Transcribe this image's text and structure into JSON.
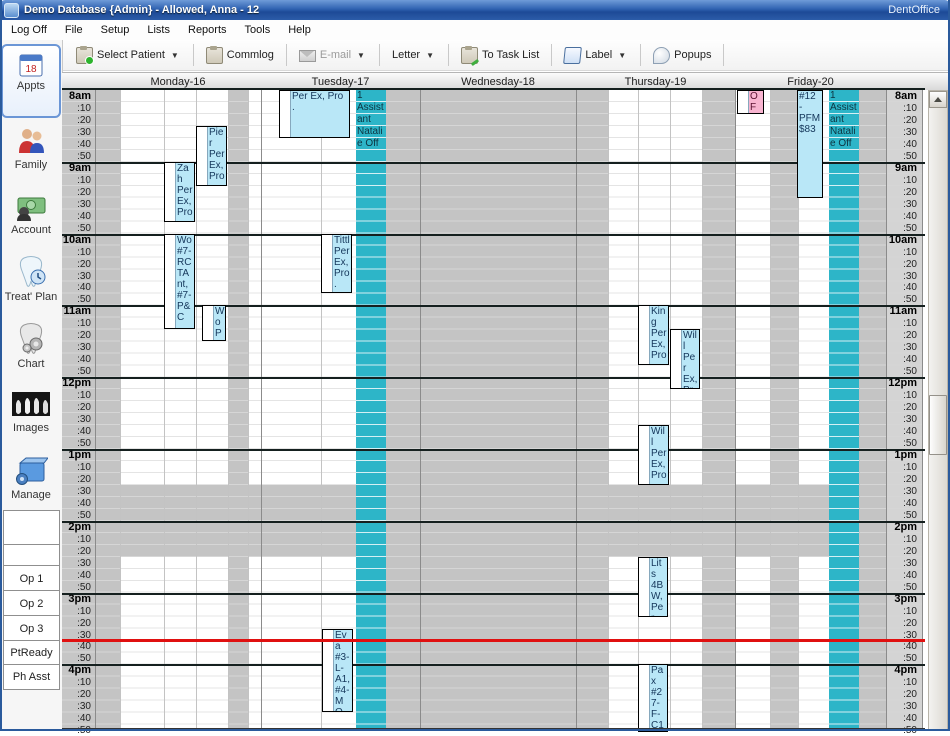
{
  "window": {
    "title": "Demo Database {Admin} - Allowed, Anna - 12",
    "brand": "DentOffice"
  },
  "menu": {
    "items": [
      "Log Off",
      "File",
      "Setup",
      "Lists",
      "Reports",
      "Tools",
      "Help"
    ]
  },
  "toolbar": {
    "select_patient": "Select Patient",
    "commlog": "Commlog",
    "email": "E-mail",
    "letter": "Letter",
    "to_task_list": "To Task List",
    "label": "Label",
    "popups": "Popups"
  },
  "sidebar": {
    "modules": [
      {
        "label": "Appts",
        "selected": true
      },
      {
        "label": "Family"
      },
      {
        "label": "Account"
      },
      {
        "label": "Treat' Plan"
      },
      {
        "label": "Chart"
      },
      {
        "label": "Images"
      },
      {
        "label": "Manage"
      }
    ],
    "op_buttons": [
      "",
      "",
      "Op 1",
      "Op 2",
      "Op 3",
      "PtReady",
      "Ph Asst"
    ]
  },
  "schedule": {
    "days": [
      "Monday-16",
      "Tuesday-17",
      "Wednesday-18",
      "Thursday-19",
      "Friday-20"
    ],
    "hours": [
      "8am",
      "9am",
      "10am",
      "11am",
      "12pm",
      "1pm",
      "2pm",
      "3pm",
      "4pm"
    ],
    "minutes": [
      ":10",
      ":20",
      ":30",
      ":40",
      ":50"
    ],
    "lunch_closed_band": {
      "start": "13:30",
      "end": "14:30"
    },
    "current_time": "15:40",
    "appointments": [
      {
        "id": "mon_pier",
        "day": 0,
        "start": "8:30",
        "end": "9:20",
        "text": "Pier Per Ex, Pro .",
        "kind": "appt"
      },
      {
        "id": "mon_zah",
        "day": 0,
        "start": "9:00",
        "end": "9:50",
        "text": "Zah Per Ex, Pro .",
        "kind": "appt"
      },
      {
        "id": "mon_wo1",
        "day": 0,
        "start": "10:00",
        "end": "11:20",
        "text": "Wo #7-RCTAnt, #7-P&C",
        "kind": "appt"
      },
      {
        "id": "mon_wo2",
        "day": 0,
        "start": "11:00",
        "end": "11:30",
        "text": "Wo Pro Chi",
        "kind": "appt"
      },
      {
        "id": "tue_per",
        "day": 1,
        "start": "8:00",
        "end": "8:40",
        "text": "Per Ex, Pro .",
        "kind": "appt"
      },
      {
        "id": "tue_tittl",
        "day": 1,
        "start": "10:00",
        "end": "10:50",
        "text": "Tittl Per Ex, Pro .",
        "kind": "appt"
      },
      {
        "id": "tue_eva",
        "day": 1,
        "start": "15:30",
        "end": "16:40",
        "text": "Eva #3-L-A1, #4-MO -",
        "kind": "appt"
      },
      {
        "id": "thu_king",
        "day": 3,
        "start": "11:00",
        "end": "11:50",
        "text": "King Per Ex, Pro .",
        "kind": "appt"
      },
      {
        "id": "thu_will1",
        "day": 3,
        "start": "11:20",
        "end": "12:10",
        "text": "Will Per Ex, Pro .",
        "kind": "appt"
      },
      {
        "id": "thu_will2",
        "day": 3,
        "start": "12:40",
        "end": "13:30",
        "text": "Will Per Ex, Pro .",
        "kind": "appt"
      },
      {
        "id": "thu_lits",
        "day": 3,
        "start": "14:30",
        "end": "15:20",
        "text": "Lits 4BW, Per Ex,",
        "kind": "appt"
      },
      {
        "id": "thu_pax",
        "day": 3,
        "start": "16:00",
        "end": "17:00",
        "text": "Pax #27-F-C1, #28",
        "kind": "appt"
      },
      {
        "id": "fri_off",
        "day": 4,
        "start": "8:00",
        "end": "8:20",
        "text": "OFF",
        "kind": "off"
      },
      {
        "id": "fri_12",
        "day": 4,
        "start": "8:00",
        "end": "9:30",
        "text": "#12 - PFM $83",
        "kind": "appt_nostrip"
      }
    ],
    "blockouts": [
      {
        "id": "bo_tue",
        "day": 1,
        "start": "8:00",
        "end": "8:50",
        "text": "1 Assistant Natalie Off"
      },
      {
        "id": "bo_fri",
        "day": 4,
        "start": "8:00",
        "end": "8:50",
        "text": "1 Assistant Natalie Off"
      }
    ],
    "colors": {
      "appointment_blue": "#b9e7f7",
      "blockout_teal": "#2db5c8",
      "off_pink": "#f8b4d0",
      "closed_gray": "#c4c4c4",
      "open_white": "#ffffff",
      "current_time_red": "#e01010"
    }
  }
}
